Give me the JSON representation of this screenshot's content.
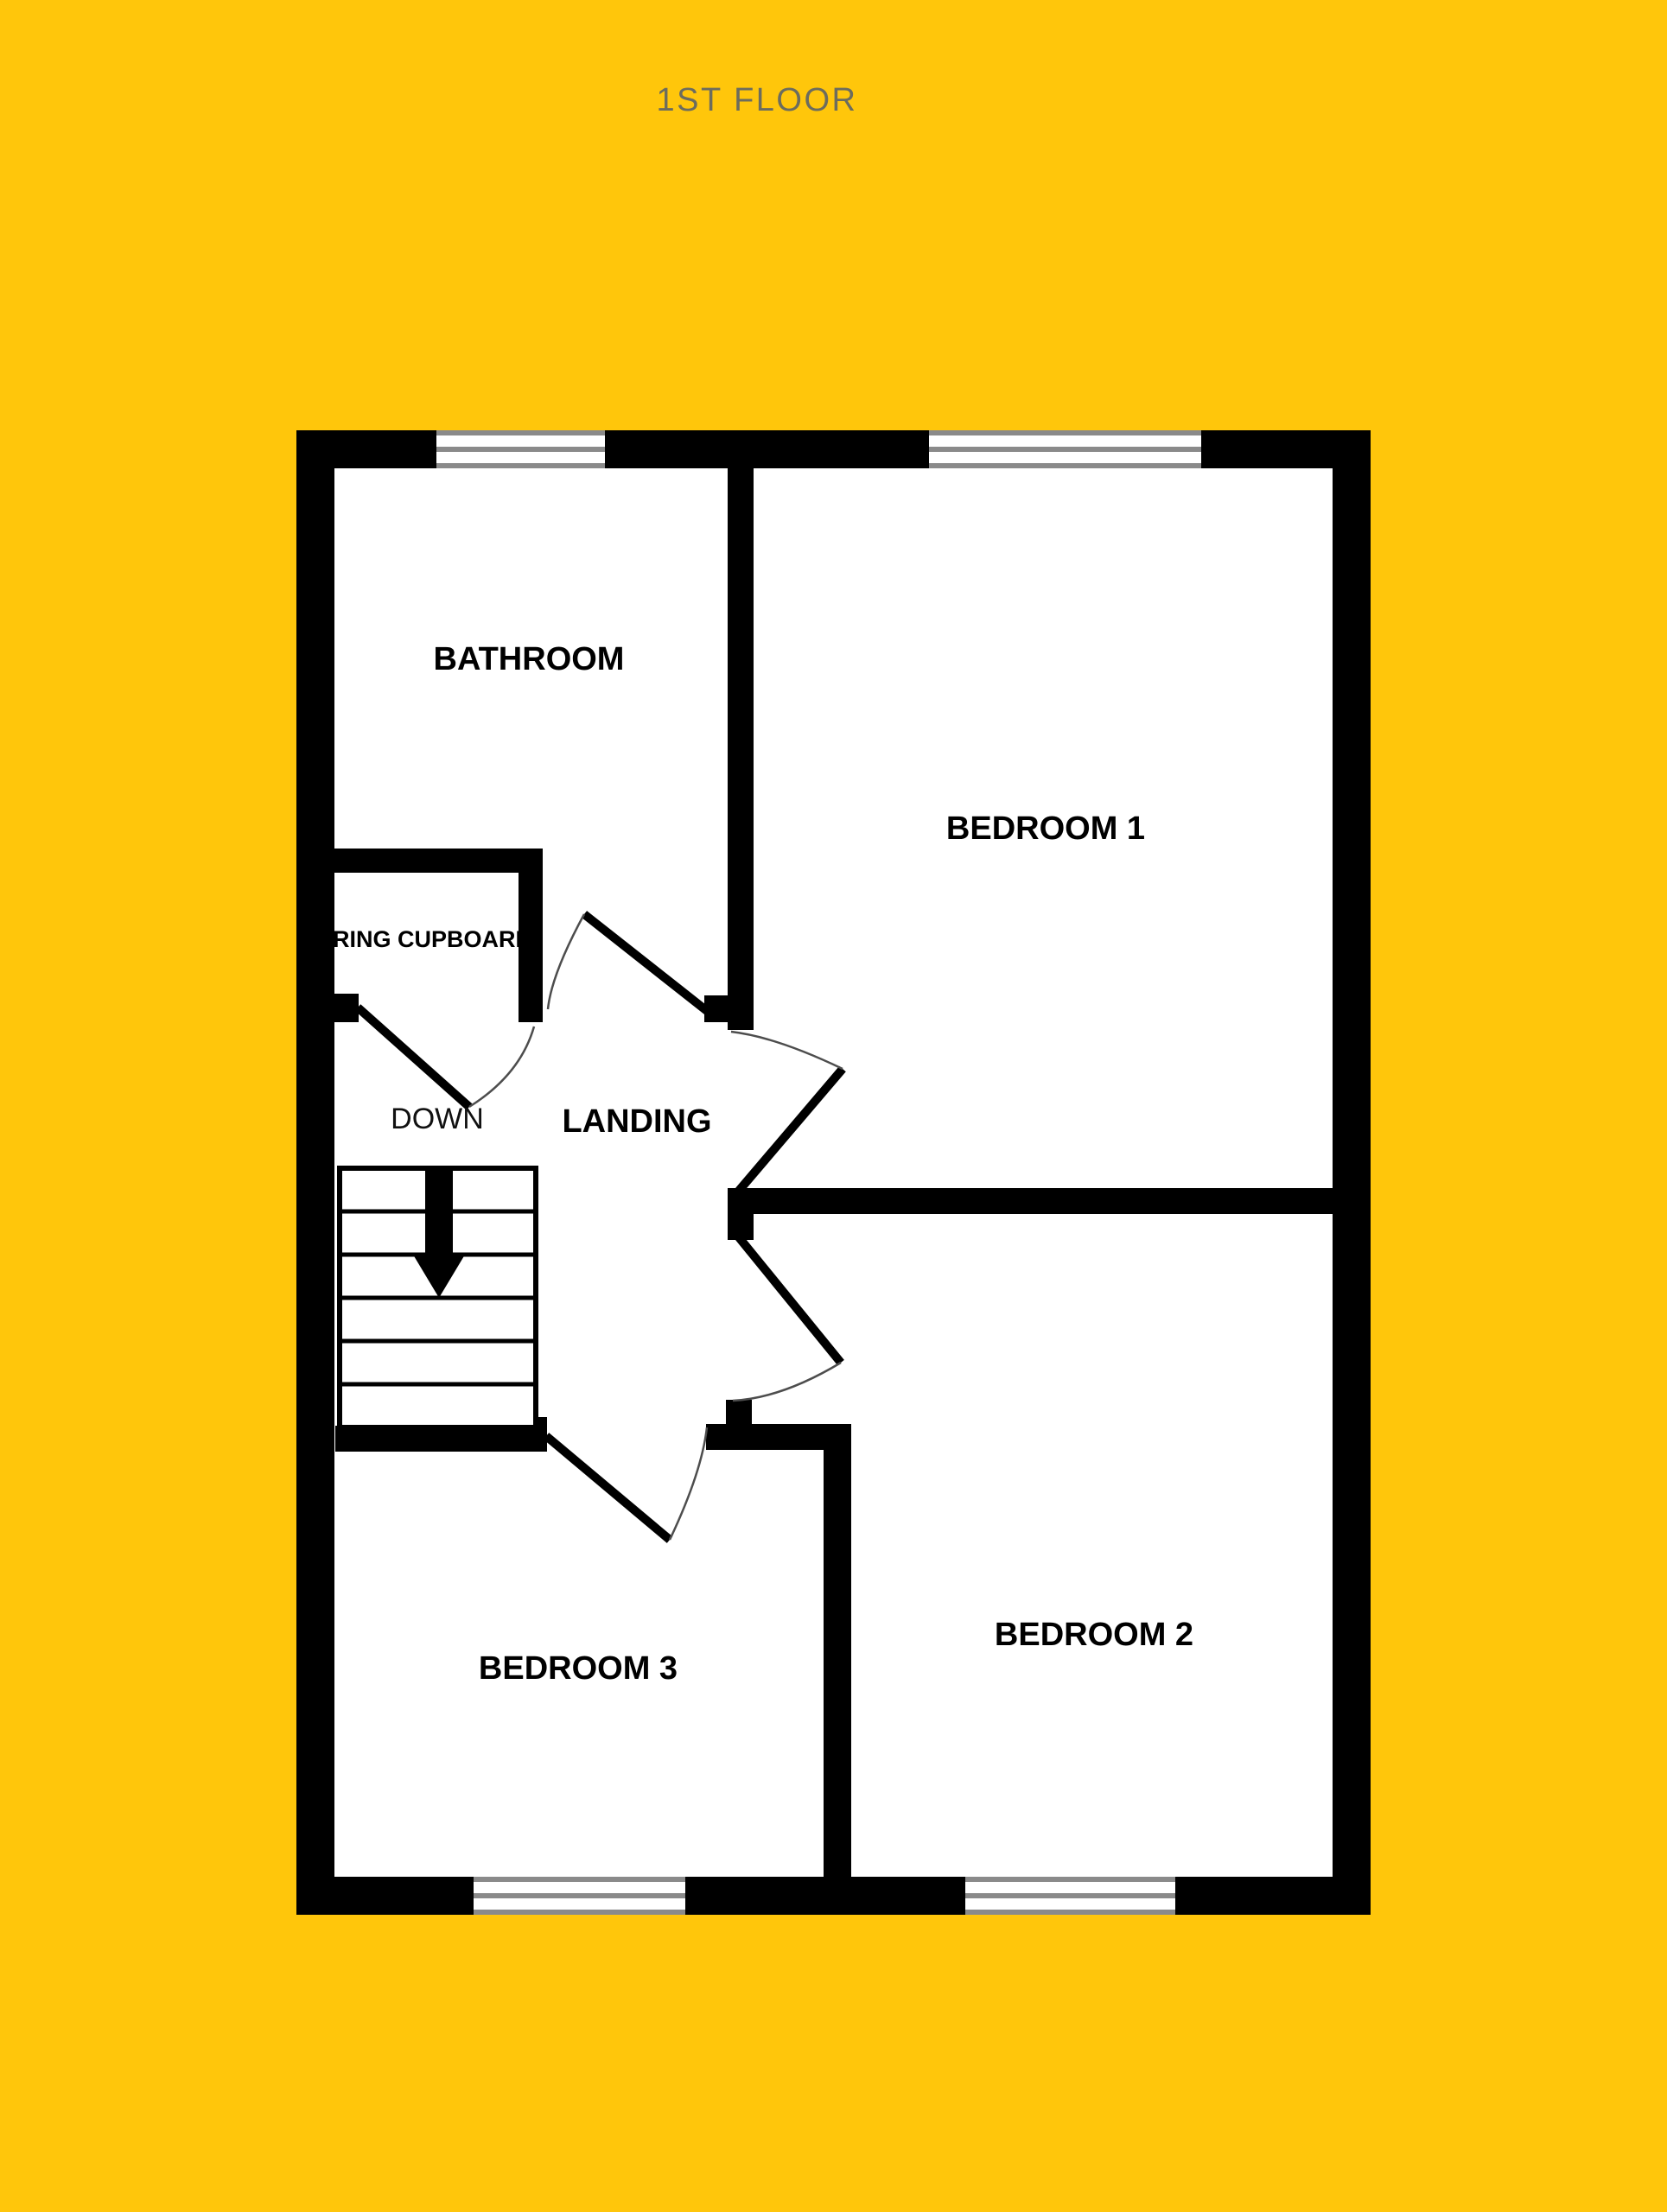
{
  "title": "1ST FLOOR",
  "floor_plan": {
    "rooms": [
      {
        "id": "bathroom",
        "label": "BATHROOM"
      },
      {
        "id": "bedroom-1",
        "label": "BEDROOM 1"
      },
      {
        "id": "bedroom-2",
        "label": "BEDROOM 2"
      },
      {
        "id": "bedroom-3",
        "label": "BEDROOM 3"
      },
      {
        "id": "landing",
        "label": "LANDING"
      },
      {
        "id": "airing-cupboard",
        "label": "AIRING CUPBOARD"
      }
    ],
    "stairs": {
      "direction_label": "DOWN"
    },
    "window_count": 4,
    "door_count": 5,
    "colors": {
      "background": "#FFC60B",
      "walls": "#000000",
      "room_fill": "#FFFFFF",
      "window_frame": "#8A8A8A",
      "title_text": "#6C6C5E",
      "label_text": "#000000"
    }
  }
}
